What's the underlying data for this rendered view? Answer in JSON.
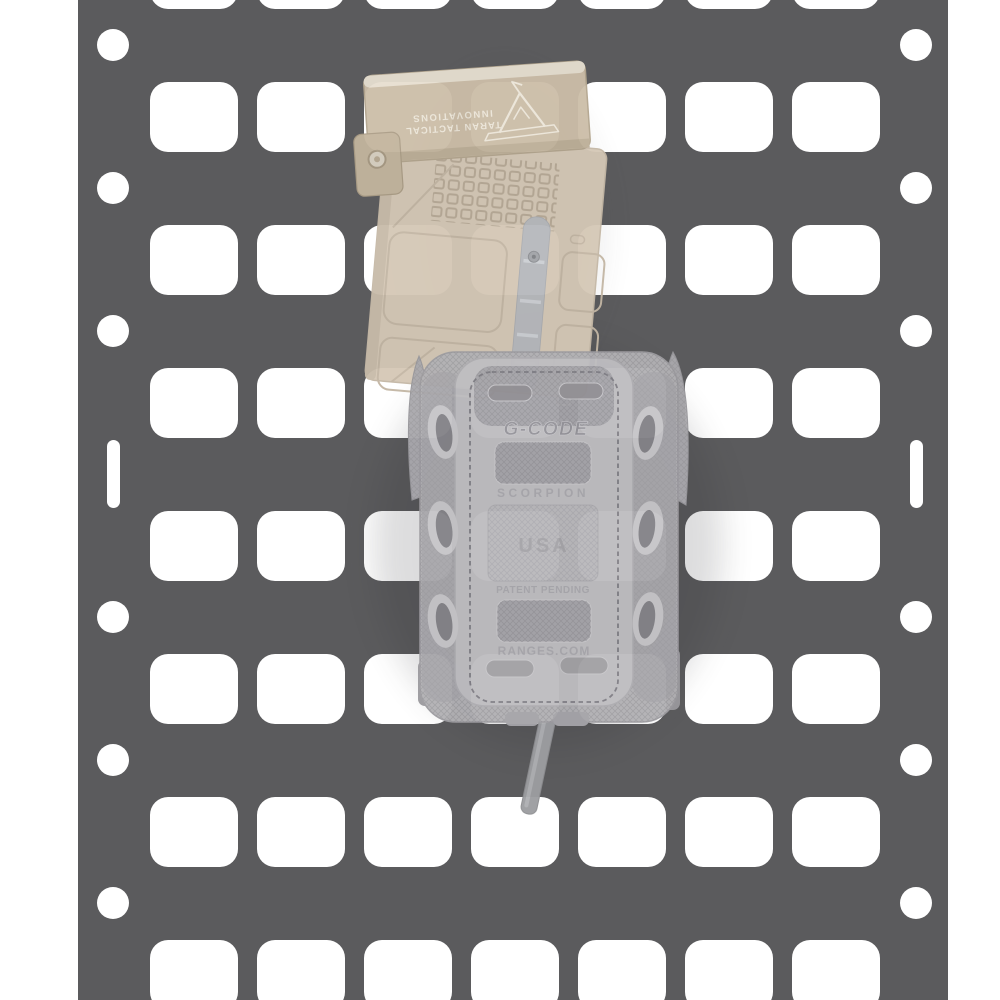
{
  "meta": {
    "description": "Product photo: FDE rifle magazine with Taran Tactical base pad inserted upside-down into a gray G-Code Soft Shell Scorpion mag carrier mounted on a dark gray rigid MOLLE panel",
    "background": "#ffffff"
  },
  "colors": {
    "panel": "#5b5b5d",
    "panel_hole": "#ffffff",
    "mag_body": "#d5c8b6",
    "mag_body_edge": "#c4b7a5",
    "mag_pad": "#ccbea8",
    "mag_pad_highlight": "#e7dfd0",
    "mag_pad_shadow": "#bdaf98",
    "engraving": "#ece6d9",
    "witness_window": "#b7b9bd",
    "pouch_shell": "#b2b1b4",
    "pouch_rail": "#a4a3a7",
    "pouch_panel": "#bfbec1",
    "pouch_texture": "#a7a6ab",
    "pouch_slot": "#918f94",
    "stitching": "#74737a",
    "emboss_text": "#96959b",
    "emboss_text_light": "#aaa9ae",
    "loop_ring": "#c7c6c9",
    "loop_hole": "#848388",
    "strap": "#9c9da0"
  },
  "molle_panel": {
    "color": "#5b5b5d",
    "hole_color": "#ffffff",
    "columns": 7,
    "rows": 8,
    "grid": {
      "col_lefts": [
        150,
        257,
        364,
        471,
        578,
        685,
        792
      ],
      "row_tops": [
        -61,
        82,
        225,
        368,
        511,
        654,
        797,
        940
      ],
      "hole_w": 88,
      "hole_h": 70
    },
    "edge_holes": {
      "xs": [
        113,
        916
      ],
      "circle_ys": [
        45,
        188,
        331,
        617,
        760,
        903
      ],
      "circle_d": 32,
      "slot_y": 440,
      "slot_w": 13,
      "slot_h": 68
    }
  },
  "magazine": {
    "basepad_text_line1": "TARAN TACTICAL",
    "basepad_text_line2": "INNOVATIONS",
    "basepad_logo": "mountain-logo",
    "orientation": "upside-down, tilted"
  },
  "pouch": {
    "brand_text": "G-CODE",
    "model_text": "SCORPION",
    "origin_text": "USA",
    "patent_text": "PATENT PENDING",
    "website_text": "RANGES.COM",
    "loops_per_side": 3
  }
}
